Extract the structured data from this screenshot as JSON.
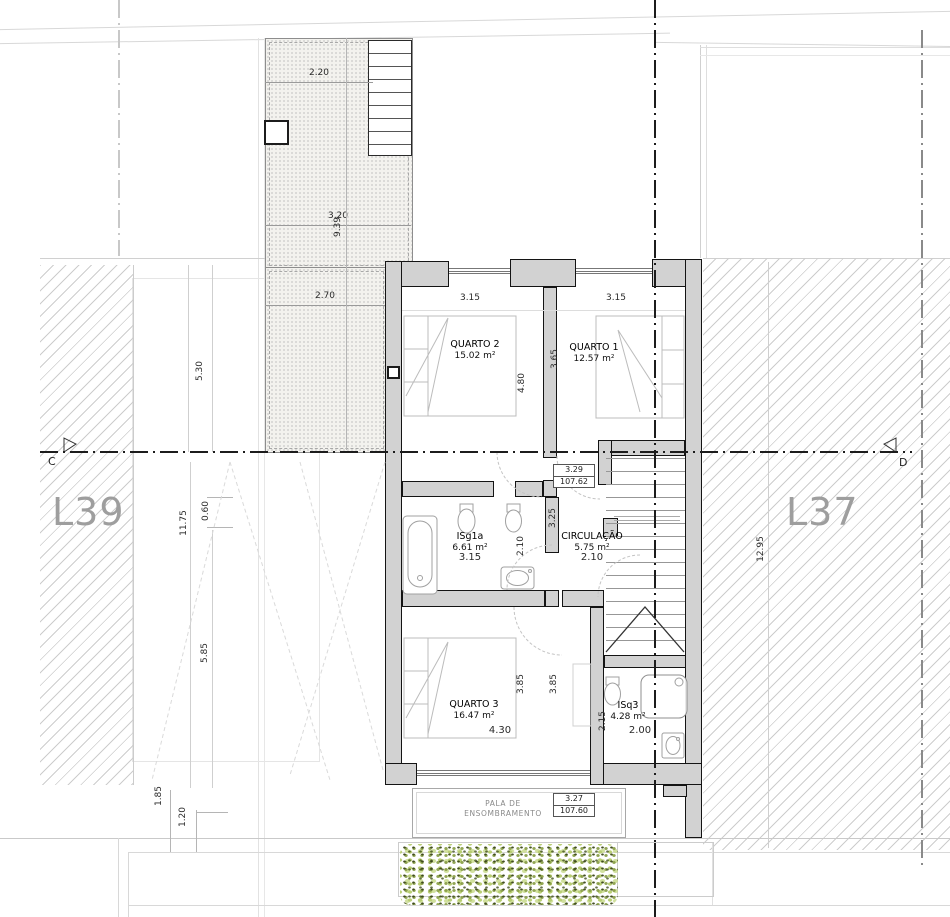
{
  "lots": {
    "left": "L39",
    "right": "L37"
  },
  "section_markers": {
    "left": "C",
    "right": "D"
  },
  "rooms": {
    "quarto2": {
      "name": "QUARTO 2",
      "area": "15.02 m²",
      "width": "3.15",
      "depth": "4.80"
    },
    "quarto1": {
      "name": "QUARTO 1",
      "area": "12.57 m²",
      "width": "3.15",
      "depth": "3.65"
    },
    "isg1a": {
      "name": "ISg1a",
      "area": "6.61 m²",
      "width": "3.15",
      "depth": "2.10"
    },
    "circulacao": {
      "name": "CIRCULAÇÃO",
      "area": "5.75 m²",
      "width": "2.10",
      "depth": "3.25"
    },
    "quarto3": {
      "name": "QUARTO 3",
      "area": "16.47 m²",
      "width": "4.30",
      "depth_a": "3.85",
      "depth_b": "3.85"
    },
    "isq3": {
      "name": "ISq3",
      "area": "4.28 m²",
      "width": "2.00",
      "depth": "2.15"
    }
  },
  "levels": {
    "upper_floor": {
      "height": "3.29",
      "elevation": "107.62"
    },
    "shading_slab": {
      "height": "3.27",
      "elevation": "107.60"
    }
  },
  "shading_canopy": {
    "line1": "PALA DE",
    "line2": "ENSOMBRAMENTO"
  },
  "site_dimensions": {
    "terrace_top_width": "2.20",
    "terrace_mid_width": "3.20",
    "terrace_length": "9.39",
    "terrace_bottom_width": "2.70",
    "left_front_depth": "5.30",
    "left_yard_depth": "11.75",
    "left_offset": "0.60",
    "left_back_depth": "5.85",
    "rear_band_a": "1.85",
    "rear_band_b": "1.20",
    "right_lot_depth": "12.95"
  },
  "colors": {
    "wall_fill": "#d2d2d2",
    "wall_line": "#141414",
    "hatch_line": "#cdcdcd",
    "hedge_light": "#b8cd74",
    "hedge_dark": "#47551f",
    "lot_label": "#9e9e9e"
  }
}
